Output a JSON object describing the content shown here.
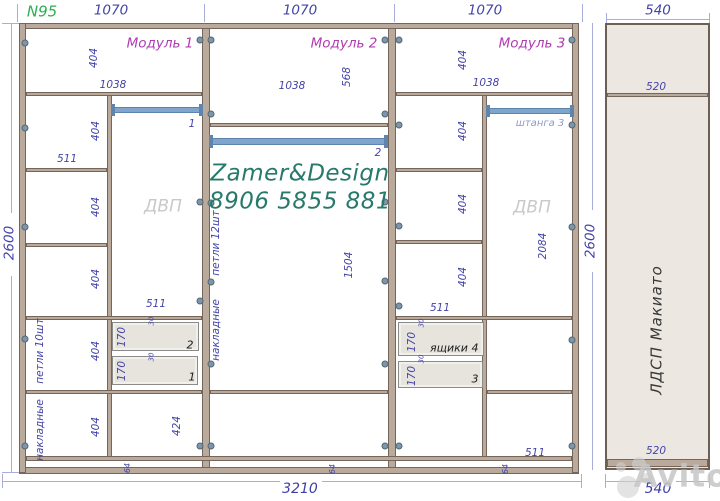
{
  "sheet": {
    "number": "N95",
    "brand": "Zamer&Design",
    "phone": "8906 5855 881",
    "material": "ЛДСП Макиато",
    "watermark": "Avito",
    "total_width": "3210",
    "total_height": "2600",
    "module_width": "1070",
    "side_panel_width": "540",
    "module_titles": [
      "Модуль 1",
      "Модуль 2",
      "Модуль 3"
    ],
    "colors": {
      "dimension_text": "#4444a8",
      "module_title": "#b03cb0",
      "sheet_number_green": "#2fae53",
      "brand_teal": "#27796b",
      "wood_panel": "#b9aa9c",
      "rod_blue": "#7fa5cd",
      "dvp_gray": "#c9c9c9",
      "side_panel_fill": "#ece8e1"
    }
  },
  "labels": [
    {
      "t": "N95",
      "x": 42,
      "y": 12,
      "c": "green",
      "n": "sheet-number"
    },
    {
      "t": "1070",
      "x": 111,
      "y": 11,
      "c": "dim-lg",
      "n": "top-dim-module-1"
    },
    {
      "t": "1070",
      "x": 300,
      "y": 11,
      "c": "dim-lg",
      "n": "top-dim-module-2"
    },
    {
      "t": "1070",
      "x": 485,
      "y": 11,
      "c": "dim-lg",
      "n": "top-dim-module-3"
    },
    {
      "t": "540",
      "x": 658,
      "y": 11,
      "c": "dim-lg",
      "n": "top-dim-side-panel"
    },
    {
      "t": "2600",
      "x": 10,
      "y": 243,
      "c": "dim-lg v",
      "n": "left-height-dim"
    },
    {
      "t": "2600",
      "x": 591,
      "y": 241,
      "c": "dim-lg v",
      "n": "right-height-dim"
    },
    {
      "t": "3210",
      "x": 300,
      "y": 489,
      "c": "dim-xl",
      "n": "bottom-total-width"
    },
    {
      "t": "540",
      "x": 658,
      "y": 489,
      "c": "dim-xl",
      "n": "bottom-side-panel-width"
    },
    {
      "t": "Модуль 1",
      "x": 160,
      "y": 44,
      "c": "module",
      "n": "module-1-title"
    },
    {
      "t": "Модуль 2",
      "x": 344,
      "y": 44,
      "c": "module",
      "n": "module-2-title"
    },
    {
      "t": "Модуль 3",
      "x": 532,
      "y": 44,
      "c": "module",
      "n": "module-3-title"
    },
    {
      "t": "404",
      "x": 94,
      "y": 58,
      "c": "dim v",
      "n": "dim-label"
    },
    {
      "t": "1038",
      "x": 113,
      "y": 85,
      "c": "dim",
      "n": "dim-label"
    },
    {
      "t": "404",
      "x": 96,
      "y": 131,
      "c": "dim v",
      "n": "dim-label"
    },
    {
      "t": "511",
      "x": 67,
      "y": 159,
      "c": "dim",
      "n": "dim-label"
    },
    {
      "t": "404",
      "x": 96,
      "y": 207,
      "c": "dim v",
      "n": "dim-label"
    },
    {
      "t": "404",
      "x": 96,
      "y": 279,
      "c": "dim v",
      "n": "dim-label"
    },
    {
      "t": "404",
      "x": 96,
      "y": 351,
      "c": "dim v",
      "n": "dim-label"
    },
    {
      "t": "404",
      "x": 96,
      "y": 427,
      "c": "dim v",
      "n": "dim-label"
    },
    {
      "t": "петли 10шт",
      "x": 40,
      "y": 351,
      "c": "dim v",
      "n": "module-1-hinges-label"
    },
    {
      "t": "накладные",
      "x": 40,
      "y": 430,
      "c": "dim v",
      "n": "module-1-hinges-type-label"
    },
    {
      "t": "1",
      "x": 192,
      "y": 124,
      "c": "dim",
      "n": "rod-1-label"
    },
    {
      "t": "ДВП",
      "x": 163,
      "y": 207,
      "c": "dvp",
      "n": "module-1-dvp-label"
    },
    {
      "t": "511",
      "x": 156,
      "y": 304,
      "c": "dim",
      "n": "dim-label"
    },
    {
      "t": "170",
      "x": 122,
      "y": 337,
      "c": "dim v",
      "n": "dim-label"
    },
    {
      "t": "30",
      "x": 152,
      "y": 321,
      "c": "small v",
      "n": "dim-label"
    },
    {
      "t": "2",
      "x": 190,
      "y": 345,
      "c": "num",
      "n": "drawer-2-number"
    },
    {
      "t": "170",
      "x": 122,
      "y": 371,
      "c": "dim v",
      "n": "dim-label"
    },
    {
      "t": "30",
      "x": 152,
      "y": 357,
      "c": "small v",
      "n": "dim-label"
    },
    {
      "t": "1",
      "x": 192,
      "y": 377,
      "c": "num",
      "n": "drawer-1-number"
    },
    {
      "t": "424",
      "x": 177,
      "y": 426,
      "c": "dim v",
      "n": "dim-label"
    },
    {
      "t": "64",
      "x": 128,
      "y": 468,
      "c": "small64 v",
      "n": "module-1-plinth-height"
    },
    {
      "t": "1038",
      "x": 292,
      "y": 86,
      "c": "dim",
      "n": "dim-label"
    },
    {
      "t": "568",
      "x": 347,
      "y": 77,
      "c": "dim v",
      "n": "dim-label"
    },
    {
      "t": "2",
      "x": 378,
      "y": 153,
      "c": "dim",
      "n": "rod-2-label"
    },
    {
      "t": "Zamer&Design",
      "x": 300,
      "y": 174,
      "c": "brand",
      "n": "brand-name"
    },
    {
      "t": "8906 5855 881",
      "x": 300,
      "y": 202,
      "c": "brand",
      "n": "brand-phone"
    },
    {
      "t": "петли 12шт",
      "x": 216,
      "y": 243,
      "c": "dim v",
      "n": "module-2-hinges-label"
    },
    {
      "t": "накладные",
      "x": 216,
      "y": 330,
      "c": "dim v",
      "n": "module-2-hinges-type-label"
    },
    {
      "t": "1504",
      "x": 349,
      "y": 265,
      "c": "dim v",
      "n": "dim-label"
    },
    {
      "t": "64",
      "x": 333,
      "y": 469,
      "c": "small64 v",
      "n": "module-2-plinth-height"
    },
    {
      "t": "404",
      "x": 463,
      "y": 60,
      "c": "dim v",
      "n": "dim-label"
    },
    {
      "t": "1038",
      "x": 486,
      "y": 83,
      "c": "dim",
      "n": "dim-label"
    },
    {
      "t": "404",
      "x": 463,
      "y": 131,
      "c": "dim v",
      "n": "dim-label"
    },
    {
      "t": "404",
      "x": 463,
      "y": 204,
      "c": "dim v",
      "n": "dim-label"
    },
    {
      "t": "404",
      "x": 463,
      "y": 277,
      "c": "dim v",
      "n": "dim-label"
    },
    {
      "t": "511",
      "x": 440,
      "y": 308,
      "c": "dim",
      "n": "dim-label"
    },
    {
      "t": "штанга 3",
      "x": 540,
      "y": 124,
      "c": "rodlbl",
      "n": "rod-3-label"
    },
    {
      "t": "ДВП",
      "x": 532,
      "y": 208,
      "c": "dvp",
      "n": "module-3-dvp-label"
    },
    {
      "t": "2084",
      "x": 543,
      "y": 246,
      "c": "dim v",
      "n": "dim-label"
    },
    {
      "t": "170",
      "x": 412,
      "y": 342,
      "c": "dim v",
      "n": "dim-label"
    },
    {
      "t": "30",
      "x": 422,
      "y": 323,
      "c": "small v",
      "n": "dim-label"
    },
    {
      "t": "ящики",
      "x": 449,
      "y": 348,
      "c": "num",
      "n": "drawers-label"
    },
    {
      "t": "4",
      "x": 475,
      "y": 348,
      "c": "num",
      "n": "drawer-4-number"
    },
    {
      "t": "170",
      "x": 412,
      "y": 376,
      "c": "dim v",
      "n": "dim-label"
    },
    {
      "t": "30",
      "x": 422,
      "y": 359,
      "c": "small v",
      "n": "dim-label"
    },
    {
      "t": "3",
      "x": 475,
      "y": 379,
      "c": "num",
      "n": "drawer-3-number"
    },
    {
      "t": "511",
      "x": 535,
      "y": 453,
      "c": "dim",
      "n": "dim-label"
    },
    {
      "t": "64",
      "x": 506,
      "y": 469,
      "c": "small64 v",
      "n": "module-3-plinth-height"
    },
    {
      "t": "520",
      "x": 656,
      "y": 87,
      "c": "dim",
      "n": "side-panel-top-depth"
    },
    {
      "t": "520",
      "x": 656,
      "y": 451,
      "c": "dim",
      "n": "side-panel-bottom-depth"
    },
    {
      "t": "ЛДСП Макиато",
      "x": 657,
      "y": 330,
      "c": "material v",
      "n": "material-label"
    },
    {
      "t": "Avito",
      "x": 681,
      "y": 477,
      "c": "wm",
      "n": "watermark-text"
    }
  ],
  "fasteners": [
    [
      25,
      43
    ],
    [
      200,
      40
    ],
    [
      211,
      40
    ],
    [
      385,
      40
    ],
    [
      399,
      40
    ],
    [
      572,
      40
    ],
    [
      25,
      128
    ],
    [
      211,
      114
    ],
    [
      385,
      114
    ],
    [
      399,
      125
    ],
    [
      572,
      125
    ],
    [
      200,
      202
    ],
    [
      211,
      203
    ],
    [
      385,
      202
    ],
    [
      399,
      226
    ],
    [
      572,
      227
    ],
    [
      25,
      227
    ],
    [
      211,
      282
    ],
    [
      385,
      281
    ],
    [
      25,
      339
    ],
    [
      200,
      301
    ],
    [
      399,
      306
    ],
    [
      211,
      364
    ],
    [
      385,
      364
    ],
    [
      572,
      340
    ],
    [
      25,
      446
    ],
    [
      200,
      446
    ],
    [
      211,
      446
    ],
    [
      385,
      446
    ],
    [
      399,
      446
    ],
    [
      572,
      446
    ]
  ],
  "rods": [
    {
      "x": 112,
      "y": 107,
      "w": 90,
      "h": 6,
      "name": "hanging-rod-1"
    },
    {
      "x": 210,
      "y": 138,
      "w": 177,
      "h": 7,
      "name": "hanging-rod-2"
    },
    {
      "x": 487,
      "y": 108,
      "w": 86,
      "h": 6,
      "name": "hanging-rod-3"
    }
  ],
  "drawers": [
    {
      "x": 112,
      "y": 322,
      "w": 87,
      "h": 29,
      "name": "drawer-2"
    },
    {
      "x": 112,
      "y": 356,
      "w": 86,
      "h": 29,
      "name": "drawer-1"
    },
    {
      "x": 398,
      "y": 322,
      "w": 86,
      "h": 34,
      "name": "drawer-4"
    },
    {
      "x": 398,
      "y": 361,
      "w": 85,
      "h": 27,
      "name": "drawer-3"
    }
  ]
}
